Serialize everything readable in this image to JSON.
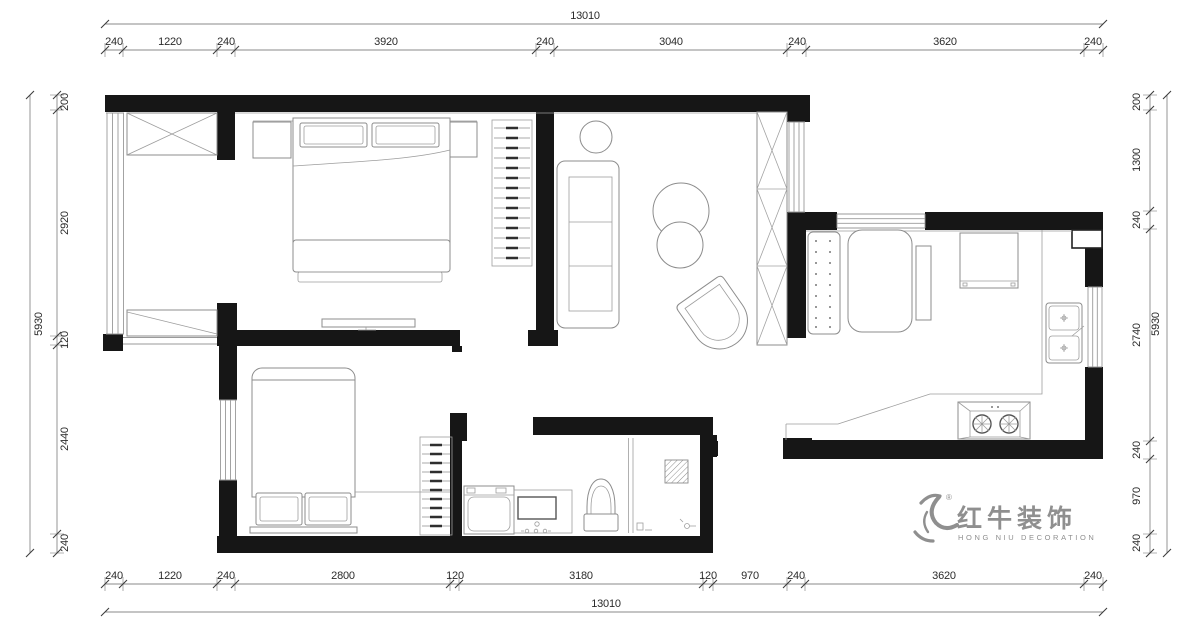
{
  "drawing": {
    "type": "residential floor plan",
    "colors": {
      "wall": "#161616",
      "line": "#8c8c8c",
      "dim_text": "#2b2b2b",
      "logo": "#8f8f8f",
      "background": "#ffffff"
    }
  },
  "dimensions": {
    "top": {
      "total": "13010",
      "segments": [
        "240",
        "1220",
        "240",
        "3920",
        "240",
        "3040",
        "240",
        "3620",
        "240"
      ]
    },
    "bottom": {
      "total": "13010",
      "segments": [
        "240",
        "1220",
        "240",
        "2800",
        "120",
        "3180",
        "120",
        "970",
        "240",
        "3620",
        "240"
      ]
    },
    "left": {
      "total": "5930",
      "segments": [
        "200",
        "2920",
        "120",
        "2440",
        "240"
      ]
    },
    "right": {
      "total": "5930",
      "segments": [
        "200",
        "1300",
        "240",
        "2740",
        "240",
        "970",
        "240"
      ]
    }
  },
  "logo": {
    "brand": "红牛装饰",
    "sub": "HONG NIU DECORATION",
    "registered": "®"
  }
}
